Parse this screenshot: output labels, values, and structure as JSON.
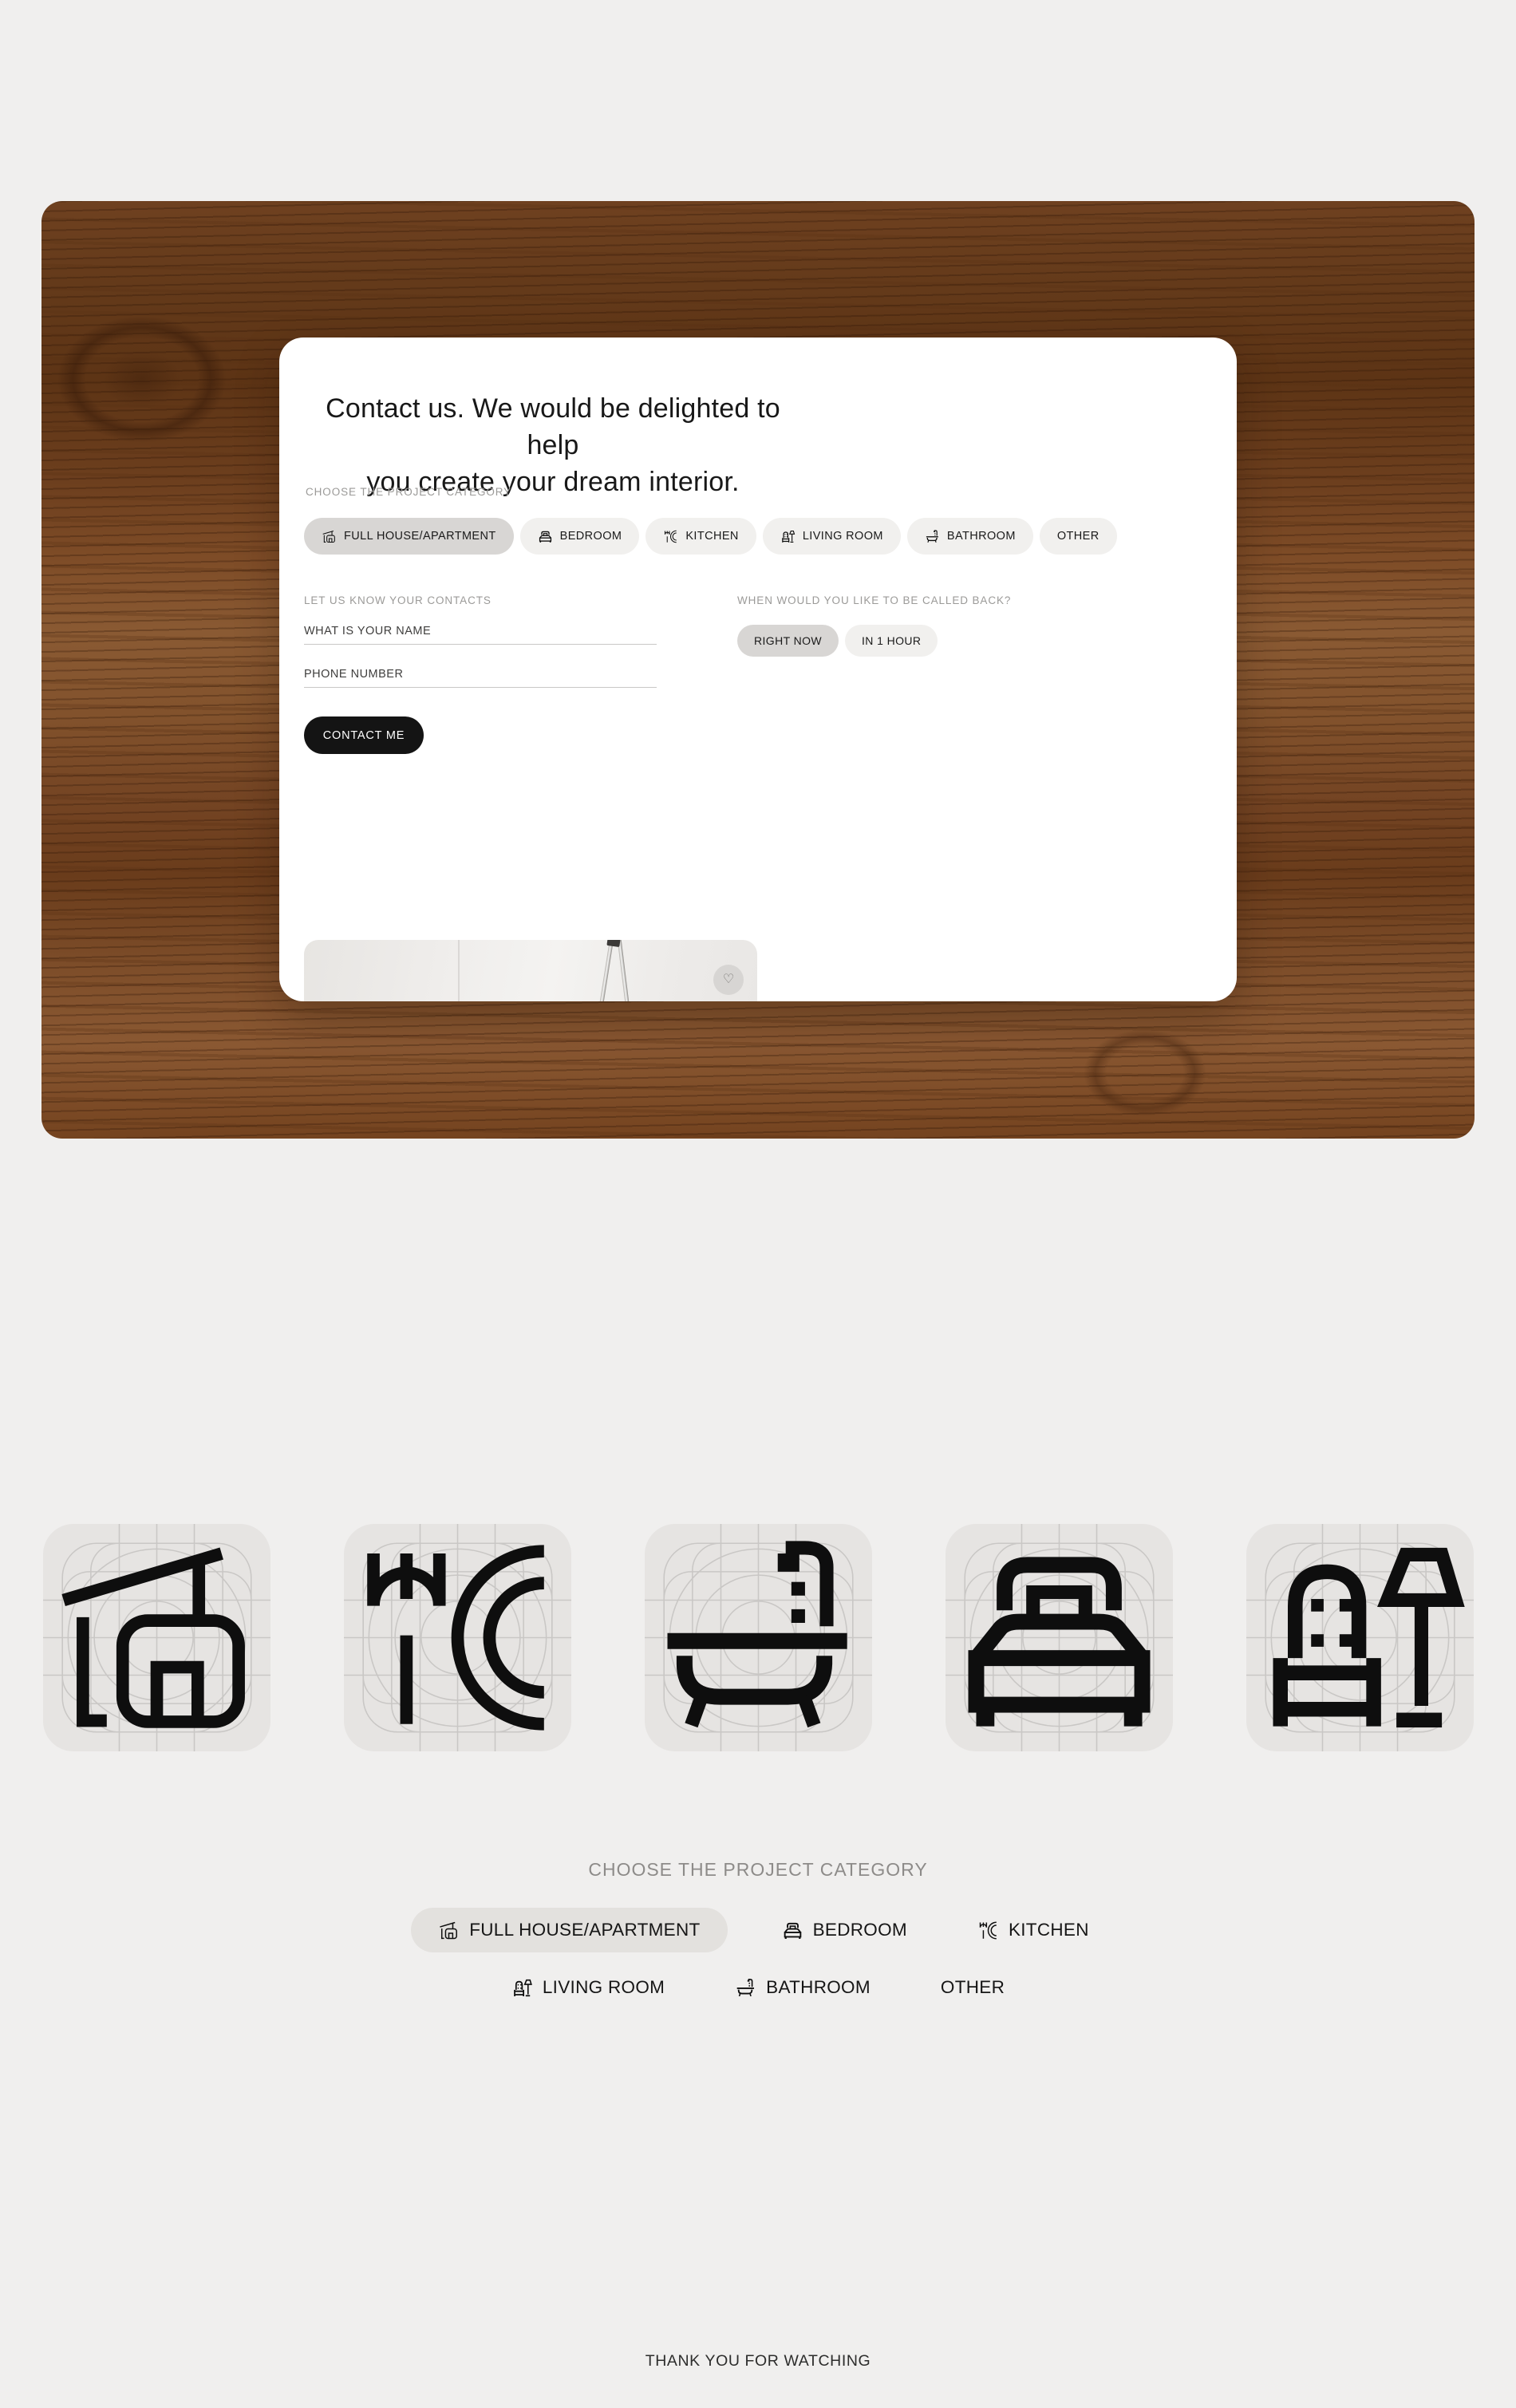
{
  "categories": [
    {
      "id": "full-house-apartment",
      "label": "FULL HOUSE/APARTMENT",
      "icon": "house",
      "selected": true
    },
    {
      "id": "bedroom",
      "label": "BEDROOM",
      "icon": "bed",
      "selected": false
    },
    {
      "id": "kitchen",
      "label": "KITCHEN",
      "icon": "kitchen",
      "selected": false
    },
    {
      "id": "living-room",
      "label": "LIVING ROOM",
      "icon": "living",
      "selected": false
    },
    {
      "id": "bathroom",
      "label": "BATHROOM",
      "icon": "bath",
      "selected": false
    },
    {
      "id": "other",
      "label": "OTHER",
      "icon": "",
      "selected": false
    }
  ],
  "card": {
    "title": "Contact us. We would be delighted to help\nyou create your dream interior.",
    "category_label": "CHOOSE THE PROJECT CATEGORY",
    "contacts_label": "LET US KNOW YOUR CONTACTS",
    "name_placeholder": "WHAT IS YOUR NAME",
    "phone_placeholder": "PHONE NUMBER",
    "callback_label": "WHEN WOULD YOU LIKE TO BE CALLED BACK?",
    "callback_options": [
      {
        "id": "right-now",
        "label": "RIGHT NOW",
        "icon": "",
        "selected": true
      },
      {
        "id": "in-1-hour",
        "label": "IN 1 HOUR",
        "icon": "",
        "selected": false
      }
    ],
    "submit_label": "CONTACT ME",
    "favorite_icon": "♡"
  },
  "icon_tiles": [
    "house",
    "kitchen",
    "bath",
    "bed",
    "living"
  ],
  "showcase": {
    "label": "CHOOSE THE PROJECT CATEGORY",
    "rows": [
      [
        0,
        1,
        2
      ],
      [
        3,
        4,
        5
      ]
    ]
  },
  "footer": {
    "text": "THANK YOU FOR WATCHING"
  },
  "colors": {
    "page_bg": "#f0efee",
    "card_bg": "#ffffff",
    "chip_selected": "#d8d6d4",
    "chip_default": "#f1f0ee",
    "showcase_chip_selected": "#e3e1de",
    "button_dark": "#141414",
    "label_gray": "#9b9a98",
    "tile_bg": "#e6e4e2",
    "wood_dark": "#5d3415",
    "wood_mid": "#774626",
    "wood_light": "#8a5a33"
  }
}
